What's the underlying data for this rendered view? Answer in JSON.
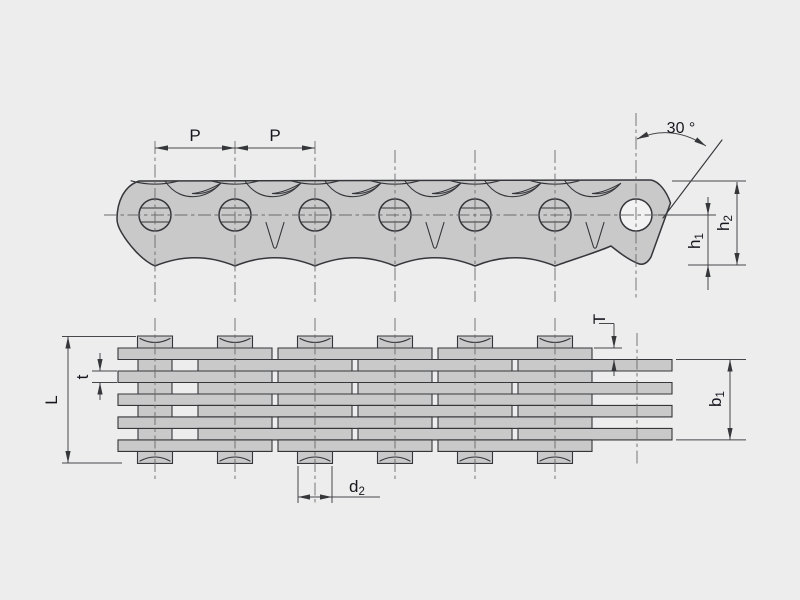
{
  "drawing": {
    "views": {
      "side_view": "chain-side-profile",
      "plan_view": "chain-top-lacing"
    }
  },
  "labels": {
    "pitch_left": "P",
    "pitch_right": "P",
    "angle": "30 °",
    "h1": {
      "base": "h",
      "sub": "1"
    },
    "h2": {
      "base": "h",
      "sub": "2"
    },
    "plate_thickness_T": "T",
    "plate_thickness_t": "t",
    "overall_width_L": "L",
    "inner_width_b1": {
      "base": "b",
      "sub": "1"
    },
    "pin_diameter_d2": {
      "base": "d",
      "sub": "2"
    }
  },
  "colors": {
    "background": "#ededed",
    "plate_fill": "#c9c9c9",
    "outline": "#35363a",
    "dimension_line": "#46474b",
    "centerline": "#6b6b6b",
    "text": "#17171f"
  }
}
